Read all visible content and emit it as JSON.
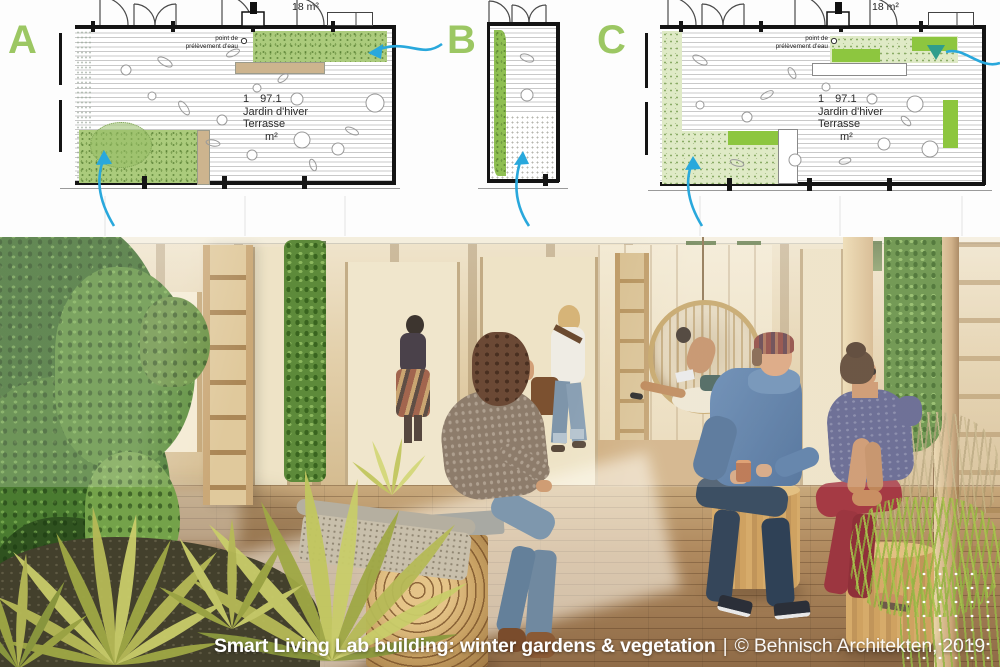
{
  "caption": {
    "title": "Smart Living Lab building: winter gardens & vegetation",
    "separator": "|",
    "credit": "© Behnisch Architekten, 2019"
  },
  "plans": {
    "labels": {
      "a": "A",
      "b": "B",
      "c": "C"
    },
    "annotations": {
      "area": "18 m²",
      "water_point_line1": "point de",
      "water_point_line2": "prélèvement d'eau"
    },
    "room": {
      "number": "1 97.1",
      "line1": "Jardin d'hiver",
      "line2": "Terrasse",
      "unit": "m²"
    },
    "colors": {
      "label_green": "#9cc763",
      "planting_green": "#abcb7c",
      "planting_light": "#dfeac6",
      "planting_bright": "#8dc63f",
      "bench_tan": "#cdb48e",
      "arrow_blue": "#29a8dc",
      "arrow_teal": "#2f9d8c"
    }
  }
}
